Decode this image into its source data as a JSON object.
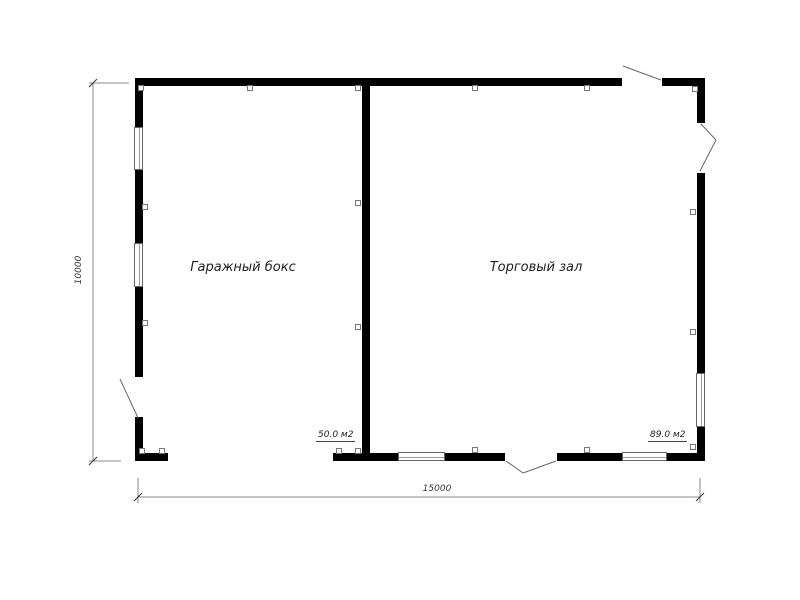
{
  "rooms": [
    {
      "name": "Гаражный бокс",
      "area": "50.0 м2"
    },
    {
      "name": "Торговый зал",
      "area": "89.0 м2"
    }
  ],
  "dimensions": {
    "overall_width": "15000",
    "overall_height": "10000"
  },
  "colors": {
    "wall": "#000000",
    "dimension_line": "#888888",
    "door_swing_line": "#666666",
    "text": "#222222"
  }
}
